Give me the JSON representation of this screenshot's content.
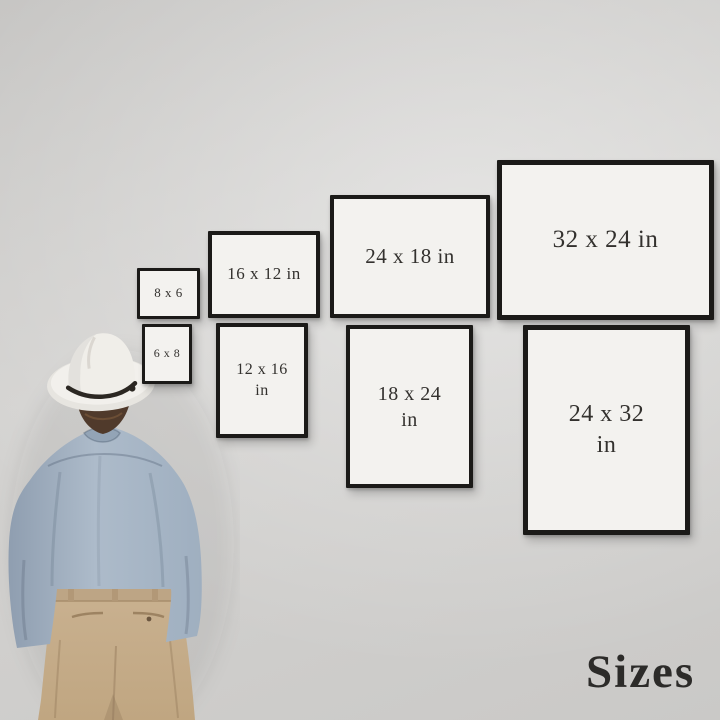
{
  "scene": {
    "title_label": "Sizes",
    "wall_color": "#cfcecc",
    "frame_border_color": "#1b1a18",
    "frame_mat_color": "#f3f2ef",
    "label_color": "#33312e",
    "figure": {
      "hat_color": "#f0eee9",
      "hat_band_color": "#2b2722",
      "hair_color": "#503a2b",
      "shirt_color": "#a9b8c7",
      "pants_color": "#c7ae8c"
    }
  },
  "frames": [
    {
      "id": "8x6",
      "orientation": "landscape",
      "lines": [
        "8 x 6"
      ],
      "x": 137,
      "y": 268,
      "w": 57,
      "h": 45,
      "border": 3,
      "font": 13
    },
    {
      "id": "16x12",
      "orientation": "landscape",
      "lines": [
        "16 x 12 in"
      ],
      "x": 208,
      "y": 231,
      "w": 104,
      "h": 79,
      "border": 4,
      "font": 17
    },
    {
      "id": "24x18",
      "orientation": "landscape",
      "lines": [
        "24 x 18 in"
      ],
      "x": 330,
      "y": 195,
      "w": 152,
      "h": 115,
      "border": 4,
      "font": 21
    },
    {
      "id": "32x24",
      "orientation": "landscape",
      "lines": [
        "32 x 24 in"
      ],
      "x": 497,
      "y": 160,
      "w": 207,
      "h": 150,
      "border": 5,
      "font": 25
    },
    {
      "id": "6x8",
      "orientation": "portrait",
      "lines": [
        "6 x 8"
      ],
      "x": 142,
      "y": 324,
      "w": 44,
      "h": 54,
      "border": 3,
      "font": 12
    },
    {
      "id": "12x16",
      "orientation": "portrait",
      "lines": [
        "12 x 16",
        "in"
      ],
      "x": 216,
      "y": 323,
      "w": 84,
      "h": 107,
      "border": 4,
      "font": 16
    },
    {
      "id": "18x24",
      "orientation": "portrait",
      "lines": [
        "18 x 24",
        "in"
      ],
      "x": 346,
      "y": 325,
      "w": 119,
      "h": 155,
      "border": 4,
      "font": 20
    },
    {
      "id": "24x32",
      "orientation": "portrait",
      "lines": [
        "24 x 32",
        "in"
      ],
      "x": 523,
      "y": 325,
      "w": 157,
      "h": 200,
      "border": 5,
      "font": 24
    }
  ]
}
